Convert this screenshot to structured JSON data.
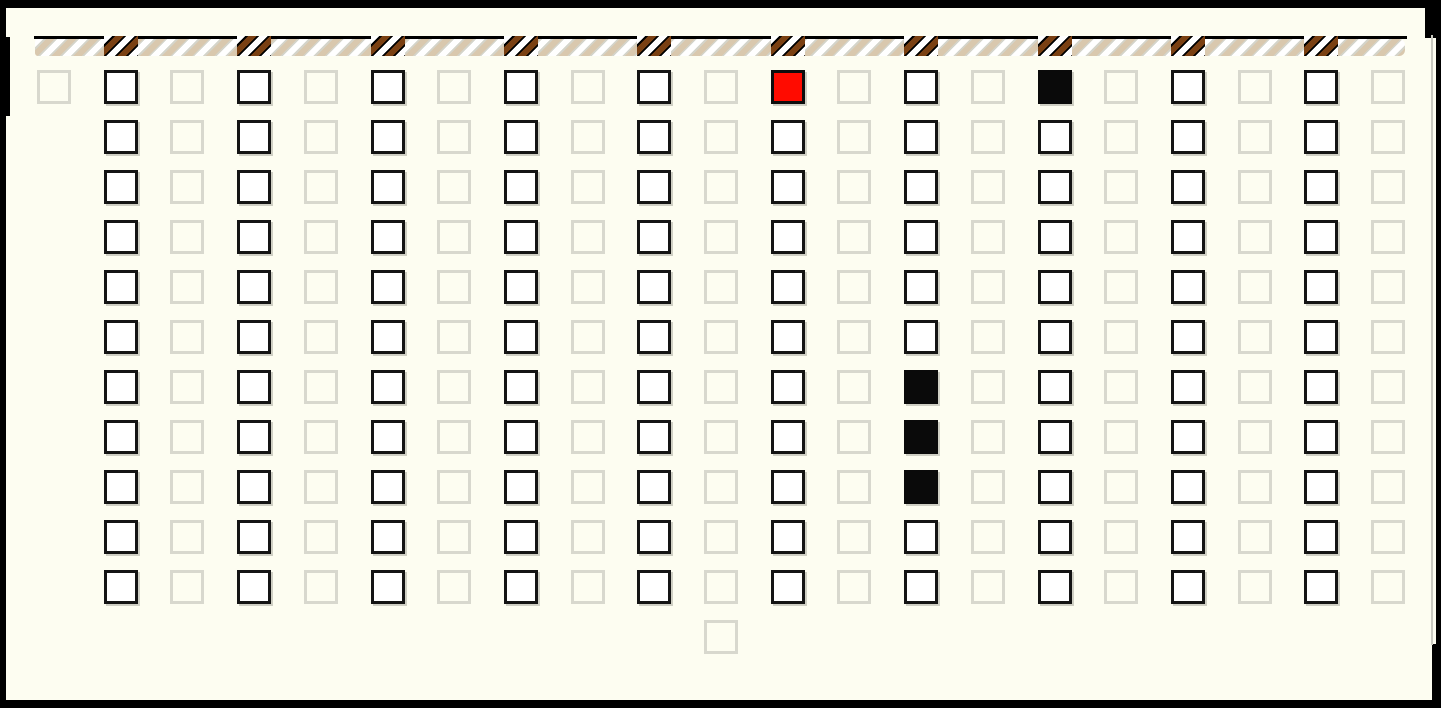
{
  "window": {
    "background_color": "#fdfdf1",
    "frame_color": "#000000"
  },
  "stripe_bar": {
    "track_color": "#d4d4ca",
    "stripe_light_color": "#ffffff",
    "stripe_tan_color": "#d9c8ae",
    "tab_color": "#000000",
    "tab_stripe_brown_color": "#7a4012",
    "tab_stripe_light_color": "#ffffff",
    "tabs_over_columns": [
      1,
      3,
      5,
      7,
      9,
      11,
      13,
      15,
      17,
      19
    ]
  },
  "grid": {
    "cols": 21,
    "rows": 11,
    "col_types": [
      "faded",
      "active",
      "faded",
      "active",
      "faded",
      "active",
      "faded",
      "active",
      "faded",
      "active",
      "faded",
      "active",
      "faded",
      "active",
      "faded",
      "active",
      "faded",
      "active",
      "faded",
      "active",
      "faded"
    ],
    "col0_rows": [
      0
    ],
    "extra_cell": {
      "col": 10,
      "row": 11,
      "type": "faded"
    },
    "filled_cells": [
      {
        "col": 11,
        "row": 0,
        "fill": "red"
      },
      {
        "col": 15,
        "row": 0,
        "fill": "black"
      },
      {
        "col": 13,
        "row": 6,
        "fill": "black"
      },
      {
        "col": 13,
        "row": 7,
        "fill": "black"
      },
      {
        "col": 13,
        "row": 8,
        "fill": "black"
      }
    ],
    "colors": {
      "active_border": "#141414",
      "active_fill": "#ffffff",
      "faded_border": "#d8d8ce",
      "red_fill": "#ff0b00",
      "black_fill": "#0a0a0a"
    }
  }
}
